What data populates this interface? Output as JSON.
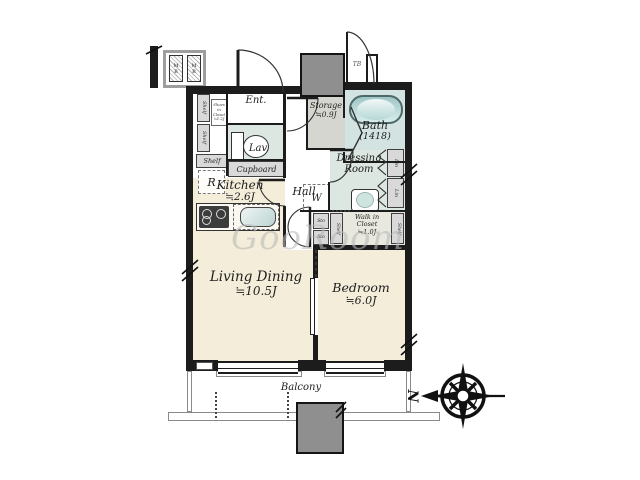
{
  "rooms": {
    "ent": {
      "label": "Ent."
    },
    "hall": {
      "label": "Hall"
    },
    "storage": {
      "label": "Storage",
      "size": "≒0.9J"
    },
    "bath": {
      "label": "Bath",
      "size": "(1418)"
    },
    "lav": {
      "label": "Lav."
    },
    "dressing": {
      "line1": "Dressing",
      "line2": "Room"
    },
    "kitchen": {
      "label": "Kitchen",
      "size": "≒2.6J"
    },
    "living": {
      "label": "Living Dining",
      "size": "≒10.5J"
    },
    "bedroom": {
      "label": "Bedroom",
      "size": "≒6.0J"
    },
    "wic": {
      "line1": "Walk in",
      "line2": "Closet",
      "size": "≒1.0J"
    },
    "balcony": {
      "label": "Balcony"
    }
  },
  "fixtures": {
    "cupboard": "Cupboard",
    "shelf": "Shelf",
    "lin": "Lin",
    "sto": "Sto",
    "fridge": "R",
    "washer": "W",
    "meter_box_m": "M",
    "meter_box_b": "B",
    "trunk_box": "TB",
    "shoes_closet_line1": "Shoes in",
    "shoes_closet_line2": "Closet",
    "shoes_closet_size": "≒1.2J"
  },
  "compass": {
    "north": "N"
  },
  "watermark": {
    "text": "GooRoom"
  },
  "colors": {
    "wall": "#1c1c1c",
    "floor_main": "#f3edda",
    "floor_wet": "#dce7e2",
    "floor_bath": "#d3e3e1",
    "floor_storage": "#d6d6d0",
    "floor_closet": "#e8e8df",
    "cabinet": "#d9d9d9",
    "pillar": "#8f8f8f",
    "watermark": "#b9b9b9"
  }
}
